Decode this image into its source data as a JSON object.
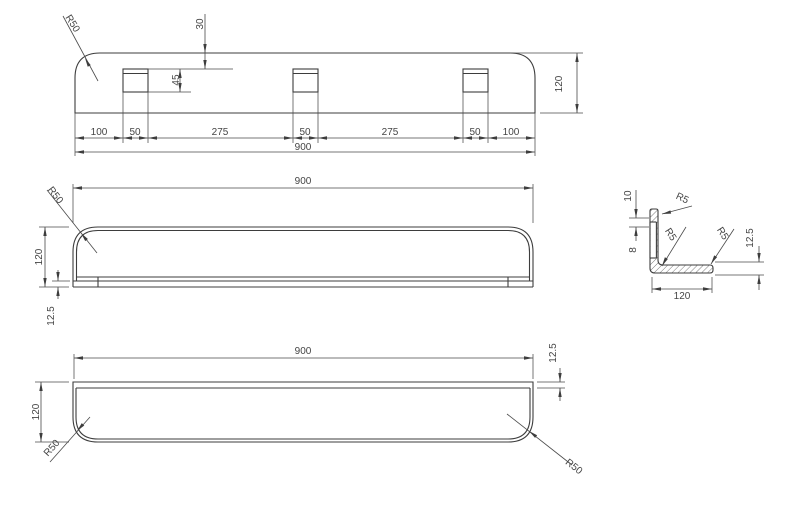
{
  "views": {
    "back_view": {
      "segment_dims": [
        "100",
        "50",
        "275",
        "50",
        "275",
        "50",
        "100"
      ],
      "total_width": "900",
      "height": "120",
      "slot_top_offset": "30",
      "slot_height": "45",
      "corner_radius": "R50"
    },
    "front_view": {
      "total_width": "900",
      "height": "120",
      "lip_height": "12.5",
      "corner_radius": "R50"
    },
    "plan_view": {
      "total_width": "900",
      "depth": "120",
      "rim_width": "12.5",
      "corner_radius_left": "R50",
      "corner_radius_right": "R50"
    },
    "section_view": {
      "depth": "120",
      "lip_height": "12.5",
      "top_offset": "10",
      "slot_width": "8",
      "fillet_radius_top": "R5",
      "fillet_radius_inner": "R5",
      "fillet_radius_front": "R5"
    }
  }
}
